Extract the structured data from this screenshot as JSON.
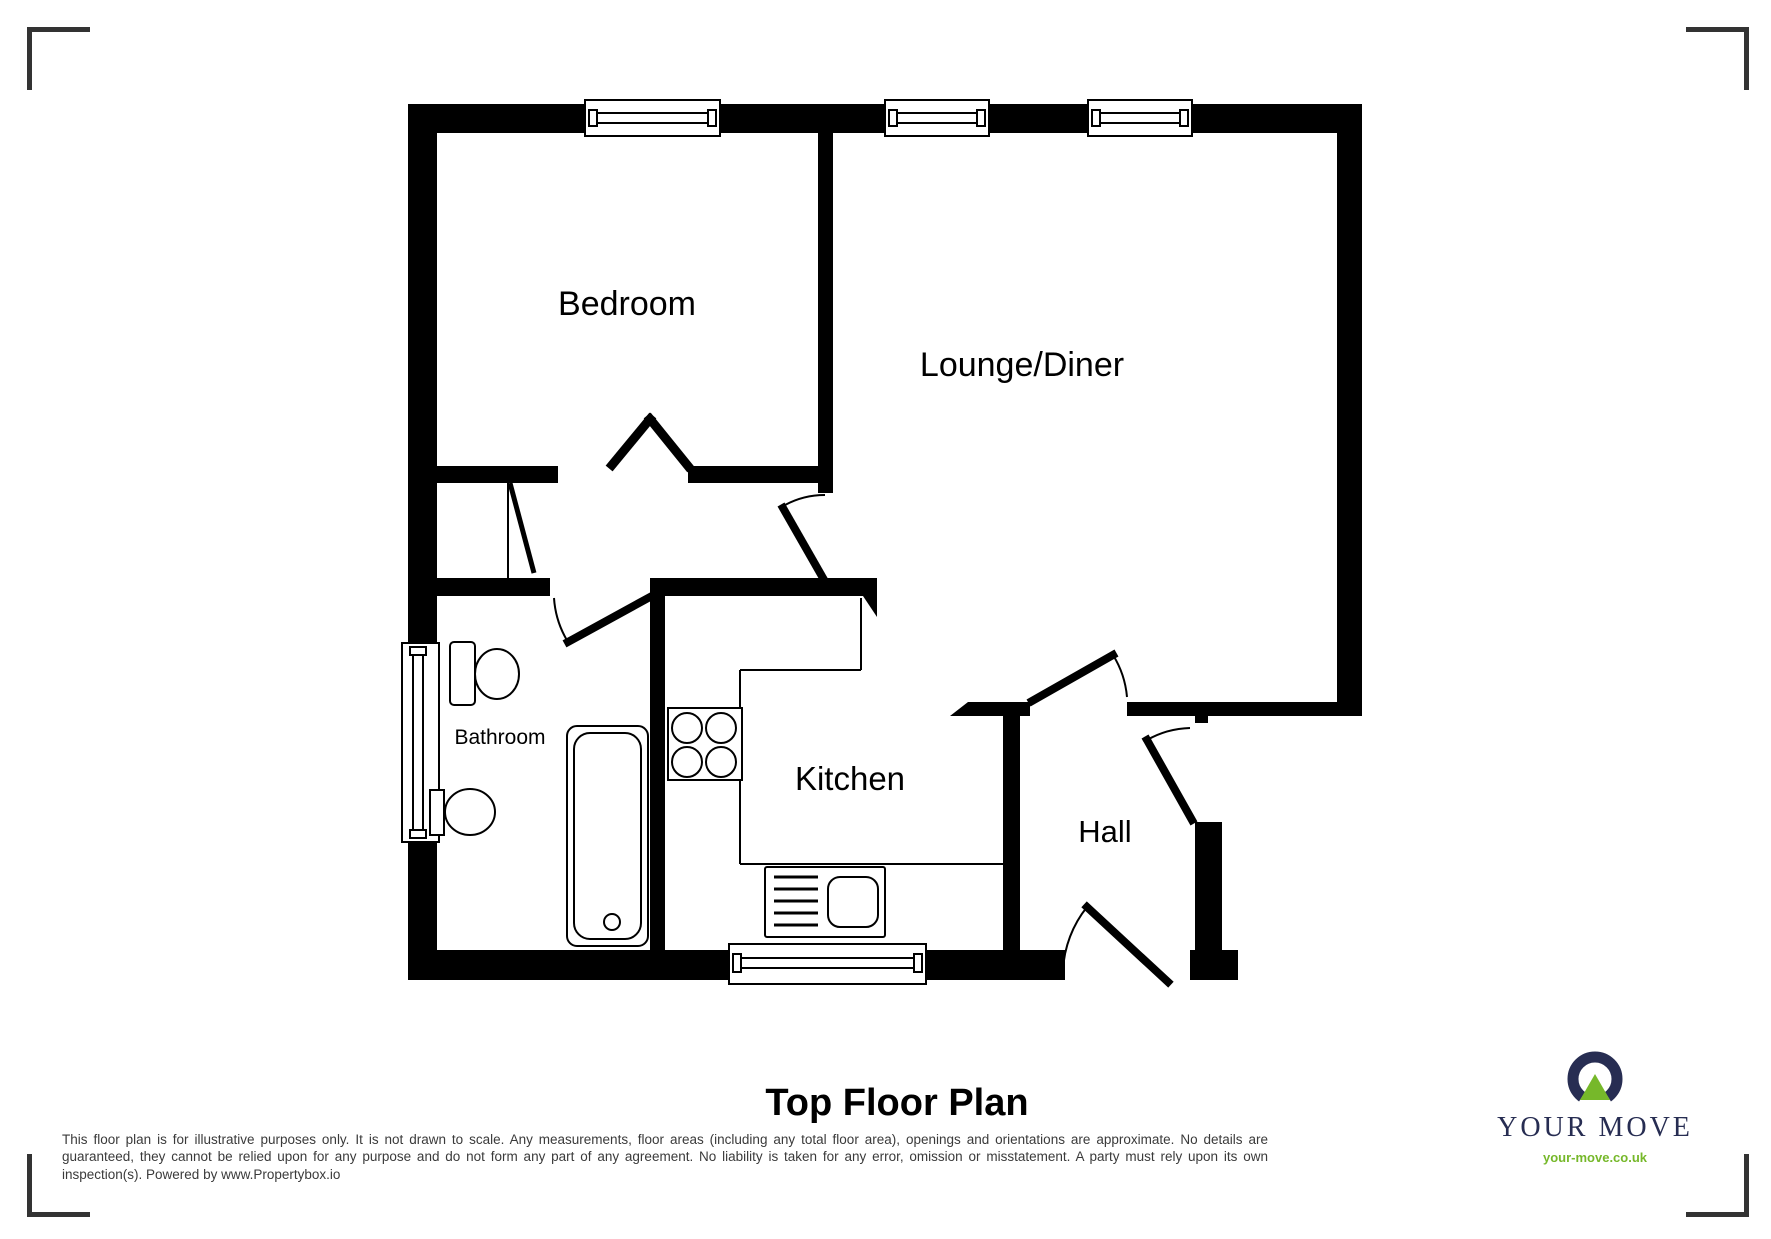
{
  "title": "Top Floor Plan",
  "rooms": {
    "bedroom": {
      "label": "Bedroom"
    },
    "lounge": {
      "label": "Lounge/Diner"
    },
    "kitchen": {
      "label": "Kitchen"
    },
    "hall": {
      "label": "Hall"
    },
    "bathroom": {
      "label": "Bathroom"
    }
  },
  "disclaimer": "This floor plan is for illustrative purposes only. It is not drawn to scale. Any measurements, floor areas (including any total floor area), openings and orientations are approximate. No details are guaranteed, they cannot be relied upon for any purpose and do not form any part of any agreement. No liability is taken for any error, omission or misstatement. A party must rely upon its own inspection(s). Powered by www.Propertybox.io",
  "logo": {
    "brand": "YOUR MOVE",
    "website": "your-move.co.uk"
  },
  "colors": {
    "wall": "#000000",
    "corner_mark": "#333333",
    "logo_navy": "#272d52",
    "logo_green": "#76b82a",
    "disclaimer_text": "#3a3a3a"
  }
}
